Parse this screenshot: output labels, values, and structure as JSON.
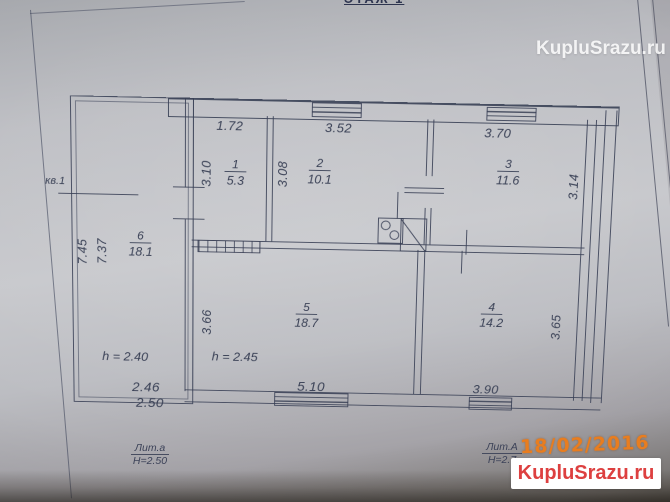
{
  "photo": {
    "floor_caption": "ЭТАЖ 1",
    "stamp_date": "18/02/2016",
    "watermark_top": "KupluSrazu.ru",
    "watermark_box": "KupluSrazu.ru"
  },
  "plan": {
    "apartment_label": "кв.1",
    "rooms": [
      {
        "number": "1",
        "area": "5.3"
      },
      {
        "number": "2",
        "area": "10.1"
      },
      {
        "number": "3",
        "area": "11.6"
      },
      {
        "number": "4",
        "area": "14.2"
      },
      {
        "number": "5",
        "area": "18.7"
      },
      {
        "number": "6",
        "area": "18.1"
      }
    ],
    "dims": {
      "room1_top": "1.72",
      "room2_top": "3.52",
      "room3_top": "3.70",
      "room1_left": "3.10",
      "room2_left": "3.08",
      "room3_right": "3.14",
      "room5_left": "3.66",
      "room4_right": "3.65",
      "annex_left_outer": "7.45",
      "annex_left_inner": "7.37",
      "room5_bottom": "5.10",
      "room4_bottom": "3.90",
      "annex_bottom_1": "2.46",
      "annex_bottom_2": "2.50"
    },
    "heights": {
      "room6": "h = 2.40",
      "room5": "h = 2.45"
    },
    "liter_annex": {
      "name": "Лит.а",
      "height": "Н=2.50"
    },
    "liter_main": {
      "name": "Лит.А",
      "height": "Н=2.7"
    }
  },
  "colors": {
    "ink": "#394055",
    "date_orange": "#e87d1f",
    "watermark_red": "#dd4040",
    "paper": "#c3c4c9"
  }
}
